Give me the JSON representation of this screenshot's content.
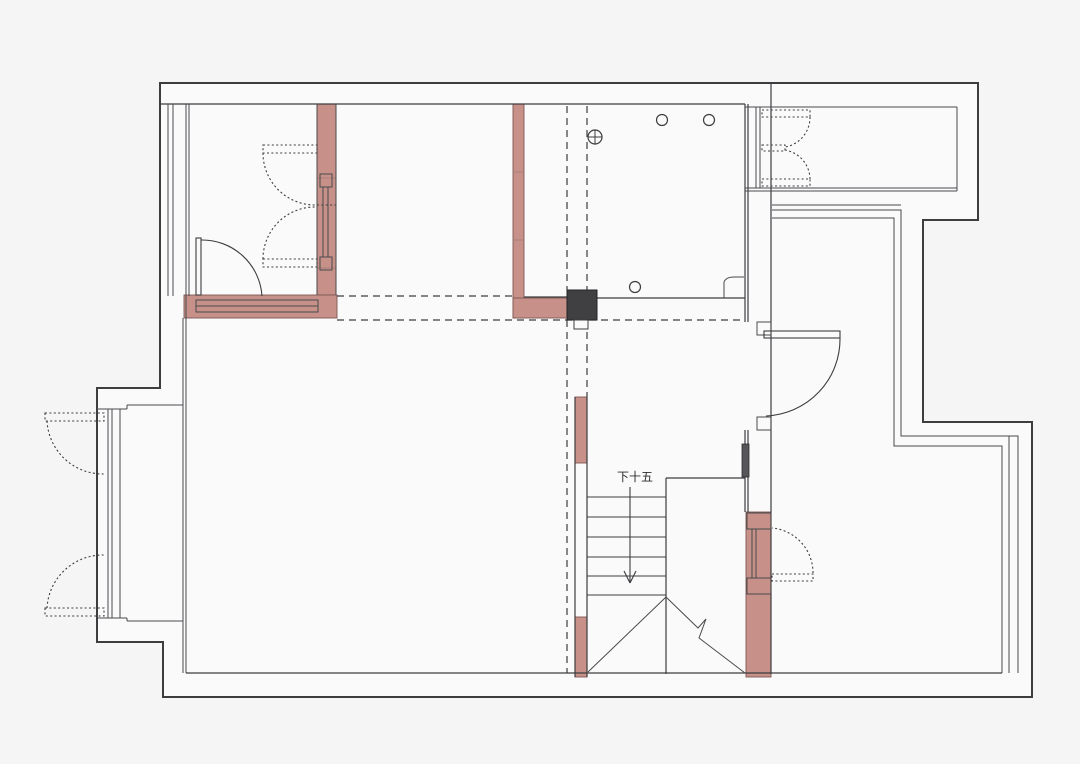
{
  "drawing": {
    "title": "renovation-floor-plan",
    "background": "#f5f5f6",
    "paper_fill": "#fafafb",
    "line_color": "#3d3d3f",
    "pink_fill": "#c7918a",
    "pink_edge": "#7d5751",
    "column_fill": "#404043",
    "stair_label": "下十五",
    "pink_walls": [
      {
        "x": 317,
        "y": 104,
        "w": 19,
        "h": 191,
        "name": "pink-wall-topleft-room-right"
      },
      {
        "x": 184,
        "y": 295,
        "w": 153,
        "h": 23,
        "name": "pink-wall-topleft-room-bottom"
      },
      {
        "x": 513,
        "y": 104,
        "w": 11,
        "h": 214,
        "name": "pink-wall-hall-left"
      },
      {
        "x": 513,
        "y": 298,
        "w": 54,
        "h": 20,
        "name": "pink-wall-hall-bottom"
      },
      {
        "x": 575,
        "y": 397,
        "w": 12,
        "h": 66,
        "name": "pink-wall-stair-left-upper"
      },
      {
        "x": 575,
        "y": 617,
        "w": 12,
        "h": 60,
        "name": "pink-wall-stair-left-lower"
      },
      {
        "x": 746,
        "y": 512,
        "w": 25,
        "h": 165,
        "name": "pink-wall-stair-right"
      }
    ],
    "column": {
      "x": 567,
      "y": 290,
      "w": 30,
      "h": 30
    },
    "column_notch": {
      "x": 574,
      "y": 320,
      "w": 14,
      "h": 9
    },
    "ceiling_marks": [
      {
        "cx": 662,
        "cy": 120,
        "r": 5.5
      },
      {
        "cx": 709,
        "cy": 120,
        "r": 5.5
      },
      {
        "cx": 635,
        "cy": 287,
        "r": 5.5
      }
    ],
    "crossed_mark": {
      "cx": 595,
      "cy": 137,
      "r": 7
    },
    "stairs": {
      "x1": 587,
      "x2": 666,
      "treads_y": [
        497,
        517,
        537,
        557,
        576,
        595
      ],
      "arrow": {
        "x": 630,
        "y1": 487,
        "y2": 583
      },
      "label_x": 635,
      "label_y": 481
    }
  }
}
